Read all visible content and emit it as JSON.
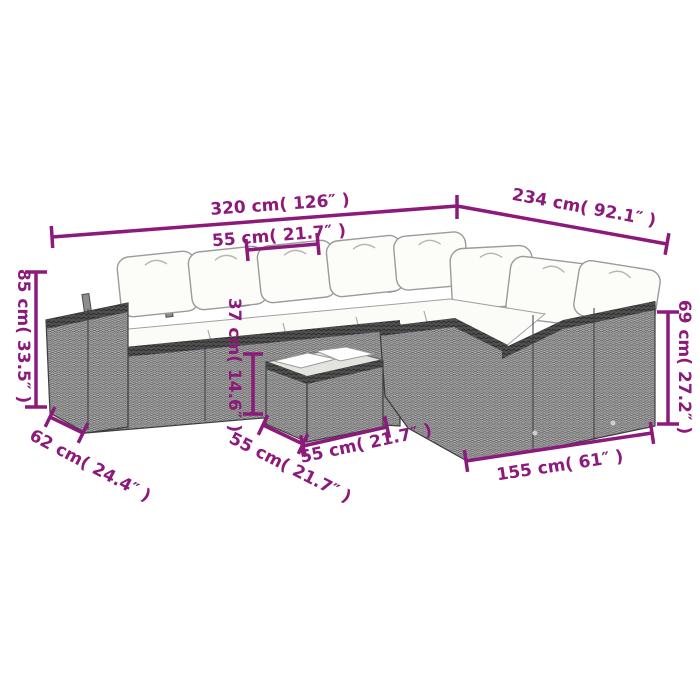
{
  "diagram": {
    "type": "product-dimension-diagram",
    "subject": "poly rattan corner sofa set with white cushions and coffee table (line-art)",
    "colors": {
      "dimension_accent": "#8b1a7b",
      "rattan_gray": "#a8a8a8",
      "rattan_rim_dark": "#4e4e4e",
      "cushion_white": "#fcfcf9",
      "background": "#ffffff"
    }
  },
  "dimensions": {
    "overall_width": "320 cm( 126″ )",
    "overall_depth": "234 cm( 92.1″ )",
    "seat_width_top": "55 cm( 21.7″ )",
    "total_height": "85 cm( 33.5″ )",
    "seat_height": "37 cm( 14.6″ )",
    "right_back_height": "69 cm( 27.2″ )",
    "armrest_depth": "62 cm( 24.4″ )",
    "table_depth": "55 cm( 21.7″ )",
    "table_width": "55 cm( 21.7″ )",
    "right_section_length": "155 cm( 61″ )"
  }
}
